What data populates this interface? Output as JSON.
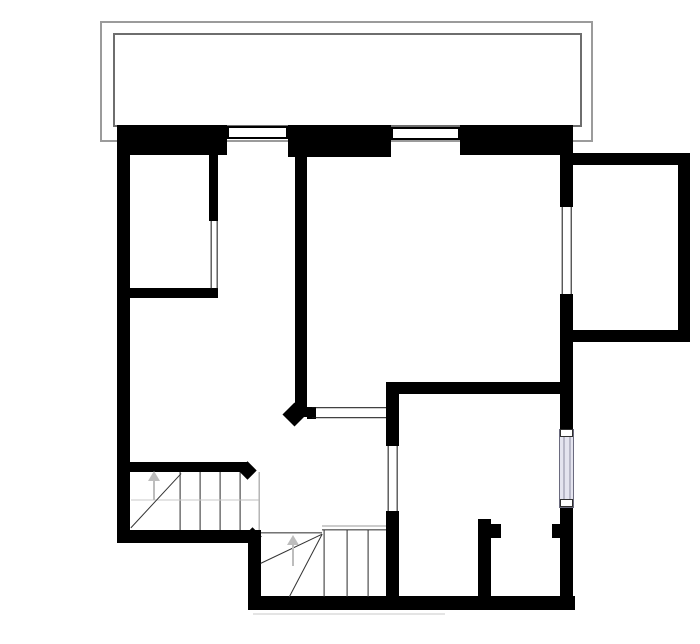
{
  "canvas": {
    "width": 700,
    "height": 644,
    "background": "#ffffff"
  },
  "colors": {
    "wall": "#000000",
    "terrace_outer_line": "#9b9b9b",
    "terrace_inner_line": "#6e6e6e",
    "opening_line": "#111111",
    "stair_tread": "#2b2b2b",
    "stair_diagonal": "#333333",
    "stair_guide": "#c6c6c6",
    "stair_edge": "#8f8f8f",
    "direction_arrow": "#bdbdbd",
    "window_fill": "#ffffff",
    "window_border": "#000000",
    "glass_fill": "#e4e4ef",
    "glass_border": "#6a6a7e",
    "glass_inner_line": "#8d8da2"
  },
  "terrace": {
    "outer": {
      "name": "terrace-outline-outer",
      "x": 100,
      "y": 21,
      "w": 493,
      "h": 121,
      "stroke": "#9b9b9b",
      "t": 2
    },
    "inner": {
      "name": "terrace-outline-inner",
      "x": 113,
      "y": 33,
      "w": 469,
      "h": 94,
      "stroke": "#6e6e6e",
      "t": 2
    }
  },
  "walls": [
    {
      "name": "left-wall",
      "x": 117,
      "y": 125,
      "w": 13,
      "h": 418
    },
    {
      "name": "top-wall-left",
      "x": 117,
      "y": 125,
      "w": 110,
      "h": 30
    },
    {
      "name": "top-wall-mid",
      "x": 288,
      "y": 125,
      "w": 103,
      "h": 32
    },
    {
      "name": "top-wall-right",
      "x": 460,
      "y": 125,
      "w": 113,
      "h": 30
    },
    {
      "name": "right-wall-upper",
      "x": 560,
      "y": 125,
      "w": 13,
      "h": 82
    },
    {
      "name": "right-wall-mid",
      "x": 560,
      "y": 294,
      "w": 13,
      "h": 138
    },
    {
      "name": "right-wall-lower",
      "x": 560,
      "y": 504,
      "w": 13,
      "h": 106
    },
    {
      "name": "bottom-wall-left",
      "x": 117,
      "y": 530,
      "w": 131,
      "h": 13
    },
    {
      "name": "left-wall-lower",
      "x": 248,
      "y": 530,
      "w": 13,
      "h": 80
    },
    {
      "name": "bottom-wall-main",
      "x": 248,
      "y": 596,
      "w": 327,
      "h": 14
    },
    {
      "name": "bumpout-wall-top",
      "x": 573,
      "y": 153,
      "w": 117,
      "h": 12
    },
    {
      "name": "bumpout-wall-right",
      "x": 678,
      "y": 153,
      "w": 12,
      "h": 189
    },
    {
      "name": "bumpout-wall-bottom",
      "x": 573,
      "y": 330,
      "w": 117,
      "h": 12
    },
    {
      "name": "room-a-wall-right",
      "x": 209,
      "y": 155,
      "w": 9,
      "h": 66
    },
    {
      "name": "room-a-wall-bottom",
      "x": 130,
      "y": 288,
      "w": 88,
      "h": 10
    },
    {
      "name": "center-wall",
      "x": 295,
      "y": 155,
      "w": 12,
      "h": 262
    },
    {
      "name": "living-wall-bottom",
      "x": 386,
      "y": 382,
      "w": 187,
      "h": 12
    },
    {
      "name": "door-wall-upper",
      "x": 386,
      "y": 382,
      "w": 13,
      "h": 64
    },
    {
      "name": "door-wall-lower",
      "x": 386,
      "y": 511,
      "w": 13,
      "h": 99
    },
    {
      "name": "threshold-stub",
      "x": 307,
      "y": 407,
      "w": 9,
      "h": 12
    },
    {
      "name": "closet-partition",
      "x": 478,
      "y": 519,
      "w": 13,
      "h": 91
    },
    {
      "name": "closet-jamb-left",
      "x": 491,
      "y": 524,
      "w": 10,
      "h": 14
    },
    {
      "name": "closet-jamb-right",
      "x": 552,
      "y": 524,
      "w": 8,
      "h": 14
    },
    {
      "name": "stair-wall-top",
      "x": 130,
      "y": 462,
      "w": 118,
      "h": 10
    }
  ],
  "window_boxes": [
    {
      "name": "top-window-1",
      "x": 227,
      "y": 126,
      "w": 61,
      "h": 13,
      "fill": "#ffffff",
      "stroke": "#000000",
      "t": 2
    },
    {
      "name": "top-window-2",
      "x": 391,
      "y": 127,
      "w": 69,
      "h": 13,
      "fill": "#ffffff",
      "stroke": "#000000",
      "t": 2
    },
    {
      "name": "side-window-frame",
      "x": 559,
      "y": 429,
      "w": 15,
      "h": 79,
      "fill": "#e4e4ef",
      "stroke": "#6a6a7e",
      "t": 1
    },
    {
      "name": "side-window-cap-top",
      "x": 560,
      "y": 429,
      "w": 13,
      "h": 8,
      "fill": "#ffffff",
      "stroke": "#2f2f2f",
      "t": 1
    },
    {
      "name": "side-window-cap-bottom",
      "x": 560,
      "y": 499,
      "w": 13,
      "h": 8,
      "fill": "#ffffff",
      "stroke": "#2f2f2f",
      "t": 1
    }
  ],
  "lines": [
    {
      "name": "room-a-opening-line-1",
      "x1": 210.5,
      "y1": 221,
      "x2": 210.5,
      "y2": 289,
      "t": 1.3,
      "color": "#111111"
    },
    {
      "name": "room-a-opening-line-2",
      "x1": 216.5,
      "y1": 221,
      "x2": 216.5,
      "y2": 289,
      "t": 1.3,
      "color": "#111111"
    },
    {
      "name": "threshold-opening-line-1",
      "x1": 312,
      "y1": 407.5,
      "x2": 386,
      "y2": 407.5,
      "t": 1.6,
      "color": "#111111"
    },
    {
      "name": "threshold-opening-line-2",
      "x1": 312,
      "y1": 417.5,
      "x2": 386,
      "y2": 417.5,
      "t": 1.6,
      "color": "#111111"
    },
    {
      "name": "door-opening-line-1",
      "x1": 388,
      "y1": 446,
      "x2": 388,
      "y2": 511,
      "t": 1.3,
      "color": "#111111"
    },
    {
      "name": "door-opening-line-2",
      "x1": 396.5,
      "y1": 446,
      "x2": 396.5,
      "y2": 511,
      "t": 1.3,
      "color": "#111111"
    },
    {
      "name": "bumpout-window-line-1",
      "x1": 561.5,
      "y1": 207,
      "x2": 561.5,
      "y2": 294,
      "t": 1.4,
      "color": "#111111"
    },
    {
      "name": "bumpout-window-line-2",
      "x1": 570.5,
      "y1": 207,
      "x2": 570.5,
      "y2": 294,
      "t": 1.4,
      "color": "#111111"
    },
    {
      "name": "glass-inner-line-1",
      "x1": 563.5,
      "y1": 437,
      "x2": 563.5,
      "y2": 499,
      "t": 1,
      "color": "#8d8da2"
    },
    {
      "name": "glass-inner-line-2",
      "x1": 569.5,
      "y1": 437,
      "x2": 569.5,
      "y2": 499,
      "t": 1,
      "color": "#8d8da2"
    },
    {
      "name": "upper-stair-tread-1",
      "x1": 180,
      "y1": 472,
      "x2": 180,
      "y2": 530,
      "t": 1.2,
      "color": "#2b2b2b"
    },
    {
      "name": "upper-stair-tread-2",
      "x1": 200,
      "y1": 472,
      "x2": 200,
      "y2": 530,
      "t": 1.2,
      "color": "#2b2b2b"
    },
    {
      "name": "upper-stair-tread-3",
      "x1": 220,
      "y1": 472,
      "x2": 220,
      "y2": 530,
      "t": 1.2,
      "color": "#2b2b2b"
    },
    {
      "name": "upper-stair-tread-4",
      "x1": 240,
      "y1": 472,
      "x2": 240,
      "y2": 530,
      "t": 1.2,
      "color": "#2b2b2b"
    },
    {
      "name": "upper-stair-edge",
      "x1": 259,
      "y1": 472,
      "x2": 259,
      "y2": 530,
      "t": 1.3,
      "color": "#8f8f8f"
    },
    {
      "name": "upper-stair-landing-line",
      "x1": 240,
      "y1": 500,
      "x2": 259,
      "y2": 500,
      "t": 1,
      "color": "#bdbdbd"
    },
    {
      "name": "upper-stair-walk-line",
      "x1": 131,
      "y1": 500,
      "x2": 240,
      "y2": 500,
      "t": 1,
      "color": "#cacaca"
    },
    {
      "name": "upper-stair-diagonal",
      "x1": 131,
      "y1": 528,
      "x2": 181,
      "y2": 474,
      "t": 1.4,
      "color": "#333333"
    },
    {
      "name": "lower-stair-top-gray",
      "x1": 322,
      "y1": 526,
      "x2": 386,
      "y2": 526,
      "t": 1,
      "color": "#9a9a9a"
    },
    {
      "name": "lower-stair-top-black",
      "x1": 322,
      "y1": 530,
      "x2": 386,
      "y2": 530,
      "t": 1.3,
      "color": "#2b2b2b"
    },
    {
      "name": "winder-top-line",
      "x1": 261,
      "y1": 533,
      "x2": 322,
      "y2": 533,
      "t": 1.3,
      "color": "#2b2b2b"
    },
    {
      "name": "lower-stair-tread-1",
      "x1": 324,
      "y1": 530,
      "x2": 324,
      "y2": 597,
      "t": 1.2,
      "color": "#2b2b2b"
    },
    {
      "name": "lower-stair-tread-2",
      "x1": 347,
      "y1": 530,
      "x2": 347,
      "y2": 597,
      "t": 1.2,
      "color": "#2b2b2b"
    },
    {
      "name": "lower-stair-tread-3",
      "x1": 368,
      "y1": 530,
      "x2": 368,
      "y2": 597,
      "t": 1.2,
      "color": "#2b2b2b"
    },
    {
      "name": "winder-diagonal-1",
      "x1": 322,
      "y1": 534,
      "x2": 261,
      "y2": 563,
      "t": 1.4,
      "color": "#333333"
    },
    {
      "name": "winder-diagonal-2",
      "x1": 322,
      "y1": 534,
      "x2": 289,
      "y2": 597,
      "t": 1.4,
      "color": "#333333"
    },
    {
      "name": "ground-shadow-line",
      "x1": 253,
      "y1": 614,
      "x2": 445,
      "y2": 614,
      "t": 1,
      "color": "#c9c9c9"
    }
  ],
  "chamfers": [
    {
      "name": "center-wall-chamfer",
      "cx": 294,
      "cy": 414,
      "size": 17
    },
    {
      "name": "stair-wall-chamfer",
      "cx": 247,
      "cy": 470,
      "size": 13
    },
    {
      "name": "corner-chamfer",
      "cx": 252,
      "cy": 536,
      "size": 13
    }
  ],
  "arrows": [
    {
      "name": "upper-stairs-up-arrow",
      "x": 154,
      "y_tail": 500,
      "y_head": 473,
      "color": "#bdbdbd"
    },
    {
      "name": "lower-stairs-up-arrow",
      "x": 293,
      "y_tail": 566,
      "y_head": 537,
      "color": "#bdbdbd"
    }
  ]
}
